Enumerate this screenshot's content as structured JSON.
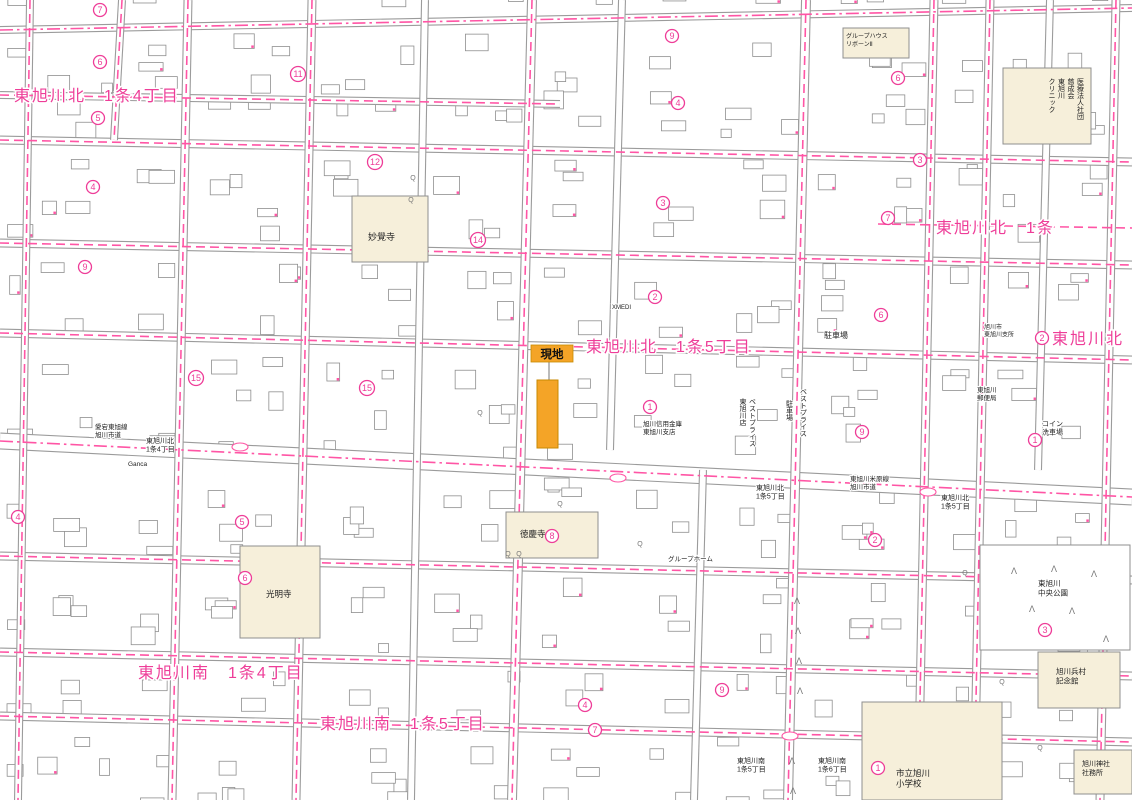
{
  "map": {
    "colors": {
      "magenta": "#ee3d98",
      "pink_line": "#ff55a5",
      "orange": "#f4a427",
      "orange_stroke": "#c98a00",
      "cream": "#f6efda",
      "road_gray": "#9b9b9b",
      "building_stroke": "#8f8f8f",
      "text_black": "#222222",
      "symbol_gray": "#777777"
    },
    "site": {
      "label": "現地",
      "parcel": {
        "x": 537,
        "y": 380,
        "w": 21,
        "h": 68
      },
      "label_box": {
        "x": 531,
        "y": 345,
        "w": 42,
        "h": 17
      }
    },
    "district_labels": [
      {
        "text": "東旭川北　1条4丁目",
        "x": 14,
        "y": 101
      },
      {
        "text": "東旭川北　1条",
        "x": 936,
        "y": 233
      },
      {
        "text": "東旭川北",
        "x": 1052,
        "y": 344,
        "circle": 2,
        "cx": 1042,
        "cy": 338
      },
      {
        "text": "東旭川北　1条5丁目",
        "x": 586,
        "y": 352
      },
      {
        "text": "東旭川南　1条4丁目",
        "x": 138,
        "y": 678
      },
      {
        "text": "東旭川南　1条5丁目",
        "x": 320,
        "y": 729
      }
    ],
    "small_labels": [
      {
        "lines": [
          "愛宕東旭線",
          "旭川市道"
        ],
        "x": 95,
        "y": 429,
        "size": 6.5
      },
      {
        "lines": [
          "東旭川北",
          "1条4丁目"
        ],
        "x": 146,
        "y": 443,
        "size": 7
      },
      {
        "lines": [
          "東旭川米原線",
          "旭川市道"
        ],
        "x": 850,
        "y": 481,
        "size": 6.5
      },
      {
        "lines": [
          "東旭川北",
          "1条5丁目"
        ],
        "x": 756,
        "y": 490,
        "size": 7
      },
      {
        "lines": [
          "東旭川北",
          "1条5丁目"
        ],
        "x": 941,
        "y": 500,
        "size": 7
      },
      {
        "lines": [
          "東旭川南",
          "1条5丁目"
        ],
        "x": 737,
        "y": 763,
        "size": 7
      },
      {
        "lines": [
          "東旭川南",
          "1条6丁目"
        ],
        "x": 818,
        "y": 763,
        "size": 7
      },
      {
        "lines": [
          "旭川信用金庫",
          "東旭川支店"
        ],
        "x": 643,
        "y": 426,
        "size": 6.5
      },
      {
        "lines": [
          "駐車場"
        ],
        "x": 824,
        "y": 338,
        "size": 8
      },
      {
        "lines": [
          "コイン",
          "洗車場"
        ],
        "x": 1042,
        "y": 426,
        "size": 7
      },
      {
        "lines": [
          "東旭川",
          "郵便局"
        ],
        "x": 977,
        "y": 392,
        "size": 6.5
      },
      {
        "lines": [
          "旭川市",
          "東旭川支所"
        ],
        "x": 984,
        "y": 329,
        "size": 6
      },
      {
        "lines": [
          "グループホーム"
        ],
        "x": 668,
        "y": 561,
        "size": 6.5
      },
      {
        "lines": [
          "Ganca"
        ],
        "x": 128,
        "y": 466,
        "size": 6.5
      },
      {
        "lines": [
          "XMEDI"
        ],
        "x": 612,
        "y": 309,
        "size": 6
      },
      {
        "lines": [
          "ベストプライス",
          "東旭川店"
        ],
        "x": 752,
        "y": 398,
        "size": 7,
        "vertical": true
      },
      {
        "lines": [
          "ベストプライス"
        ],
        "x": 803,
        "y": 388,
        "size": 7,
        "vertical": true
      },
      {
        "lines": [
          "駐車場"
        ],
        "x": 789,
        "y": 400,
        "size": 7,
        "vertical": true
      }
    ],
    "special_buildings": [
      {
        "name": "myokakuji-temple",
        "x": 352,
        "y": 196,
        "w": 76,
        "h": 66,
        "label": {
          "lines": [
            "妙覺寺"
          ],
          "x": 368,
          "y": 240,
          "size": 9
        }
      },
      {
        "name": "higashi-asahikawa-clinic",
        "x": 1003,
        "y": 68,
        "w": 88,
        "h": 76,
        "label": {
          "lines": [
            "医療法人社団",
            "慈成会",
            "東旭川",
            "クリニック"
          ],
          "x": 1080,
          "y": 78,
          "size": 7,
          "vertical": true
        }
      },
      {
        "name": "tokukeiji-temple",
        "x": 506,
        "y": 512,
        "w": 92,
        "h": 46,
        "label": {
          "lines": [
            "徳慶寺"
          ],
          "x": 520,
          "y": 537,
          "size": 8.5
        }
      },
      {
        "name": "komyoji-temple",
        "x": 240,
        "y": 546,
        "w": 80,
        "h": 92,
        "label": {
          "lines": [
            "光明寺"
          ],
          "x": 266,
          "y": 597,
          "size": 8.5
        }
      },
      {
        "name": "asahikawa-elementary-school",
        "x": 862,
        "y": 702,
        "w": 140,
        "h": 98,
        "label": {
          "lines": [
            "市立旭川",
            "小学校"
          ],
          "x": 896,
          "y": 776,
          "size": 8.5
        }
      },
      {
        "name": "heison-memorial-hall",
        "x": 1038,
        "y": 652,
        "w": 82,
        "h": 56,
        "label": {
          "lines": [
            "旭川兵村",
            "記念館"
          ],
          "x": 1056,
          "y": 674,
          "size": 7.5
        }
      },
      {
        "name": "asahikawa-shrine-office",
        "x": 1074,
        "y": 750,
        "w": 58,
        "h": 44,
        "label": {
          "lines": [
            "旭川神社",
            "社務所"
          ],
          "x": 1082,
          "y": 766,
          "size": 7
        }
      },
      {
        "name": "group-house-reborn",
        "x": 843,
        "y": 28,
        "w": 66,
        "h": 30,
        "label": {
          "lines": [
            "グループハウス",
            "リボーンⅡ"
          ],
          "x": 846,
          "y": 38,
          "size": 6
        }
      },
      {
        "name": "chuo-park",
        "x": 980,
        "y": 545,
        "w": 150,
        "h": 105,
        "fill": "#ffffff",
        "label": {
          "lines": [
            "東旭川",
            "中央公園"
          ],
          "x": 1038,
          "y": 586,
          "size": 7.5
        }
      }
    ],
    "circled_numbers": [
      {
        "n": 7,
        "x": 100,
        "y": 10
      },
      {
        "n": 6,
        "x": 100,
        "y": 62
      },
      {
        "n": 5,
        "x": 98,
        "y": 118
      },
      {
        "n": 4,
        "x": 93,
        "y": 187
      },
      {
        "n": 9,
        "x": 85,
        "y": 267
      },
      {
        "n": 11,
        "x": 298,
        "y": 74
      },
      {
        "n": 12,
        "x": 375,
        "y": 162
      },
      {
        "n": 14,
        "x": 478,
        "y": 240
      },
      {
        "n": 15,
        "x": 196,
        "y": 378
      },
      {
        "n": 15,
        "x": 367,
        "y": 388
      },
      {
        "n": 9,
        "x": 672,
        "y": 36
      },
      {
        "n": 4,
        "x": 678,
        "y": 103
      },
      {
        "n": 3,
        "x": 663,
        "y": 203
      },
      {
        "n": 2,
        "x": 655,
        "y": 297
      },
      {
        "n": 1,
        "x": 650,
        "y": 407
      },
      {
        "n": 6,
        "x": 898,
        "y": 78
      },
      {
        "n": 3,
        "x": 920,
        "y": 160
      },
      {
        "n": 7,
        "x": 888,
        "y": 218
      },
      {
        "n": 6,
        "x": 881,
        "y": 315
      },
      {
        "n": 9,
        "x": 862,
        "y": 432
      },
      {
        "n": 1,
        "x": 1035,
        "y": 440
      },
      {
        "n": 2,
        "x": 875,
        "y": 540
      },
      {
        "n": 4,
        "x": 18,
        "y": 517
      },
      {
        "n": 5,
        "x": 242,
        "y": 522
      },
      {
        "n": 6,
        "x": 245,
        "y": 578
      },
      {
        "n": 3,
        "x": 1045,
        "y": 630
      },
      {
        "n": 4,
        "x": 585,
        "y": 705
      },
      {
        "n": 9,
        "x": 722,
        "y": 690
      },
      {
        "n": 7,
        "x": 595,
        "y": 730
      },
      {
        "n": 1,
        "x": 878,
        "y": 768
      },
      {
        "n": 8,
        "x": 552,
        "y": 536
      }
    ]
  }
}
